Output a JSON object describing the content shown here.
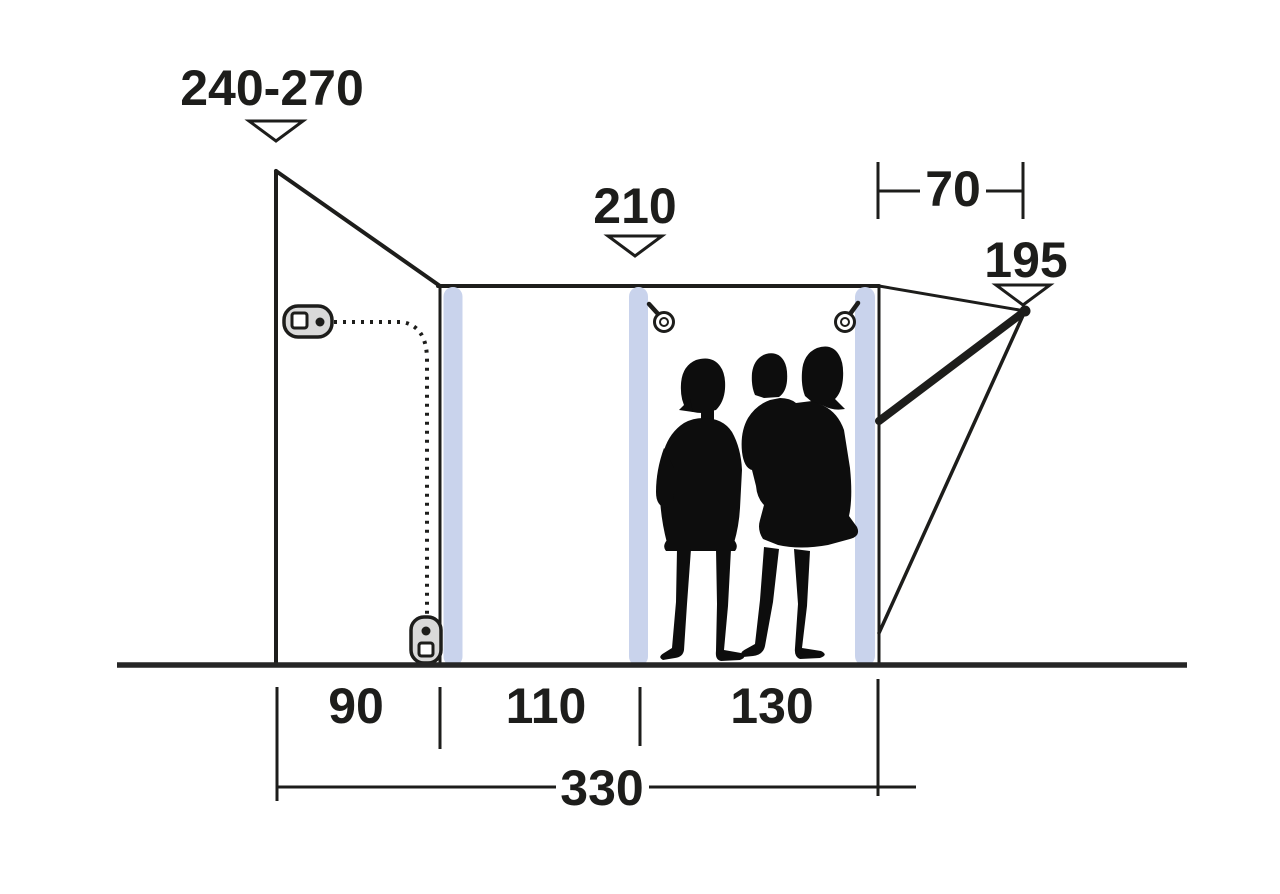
{
  "diagram": {
    "name": "tent-awning-side-profile-dimension-diagram",
    "labels": {
      "peak_height_range": "240-270",
      "mid_height": "210",
      "rear_offset": "70",
      "rear_height": "195",
      "section_width_1": "90",
      "section_width_2": "110",
      "section_width_3": "130",
      "total_width": "330"
    },
    "colors": {
      "line": "#1d1d1b",
      "ground": "#262626",
      "pole": "#c9d3ec",
      "slider_fill": "#d9d9d9",
      "silhouette": "#0d0d0d",
      "background": "#ffffff"
    },
    "icons": [
      "zipper-slider-icon",
      "zipper-ring-pull-icon",
      "dimension-arrow-icon"
    ]
  }
}
